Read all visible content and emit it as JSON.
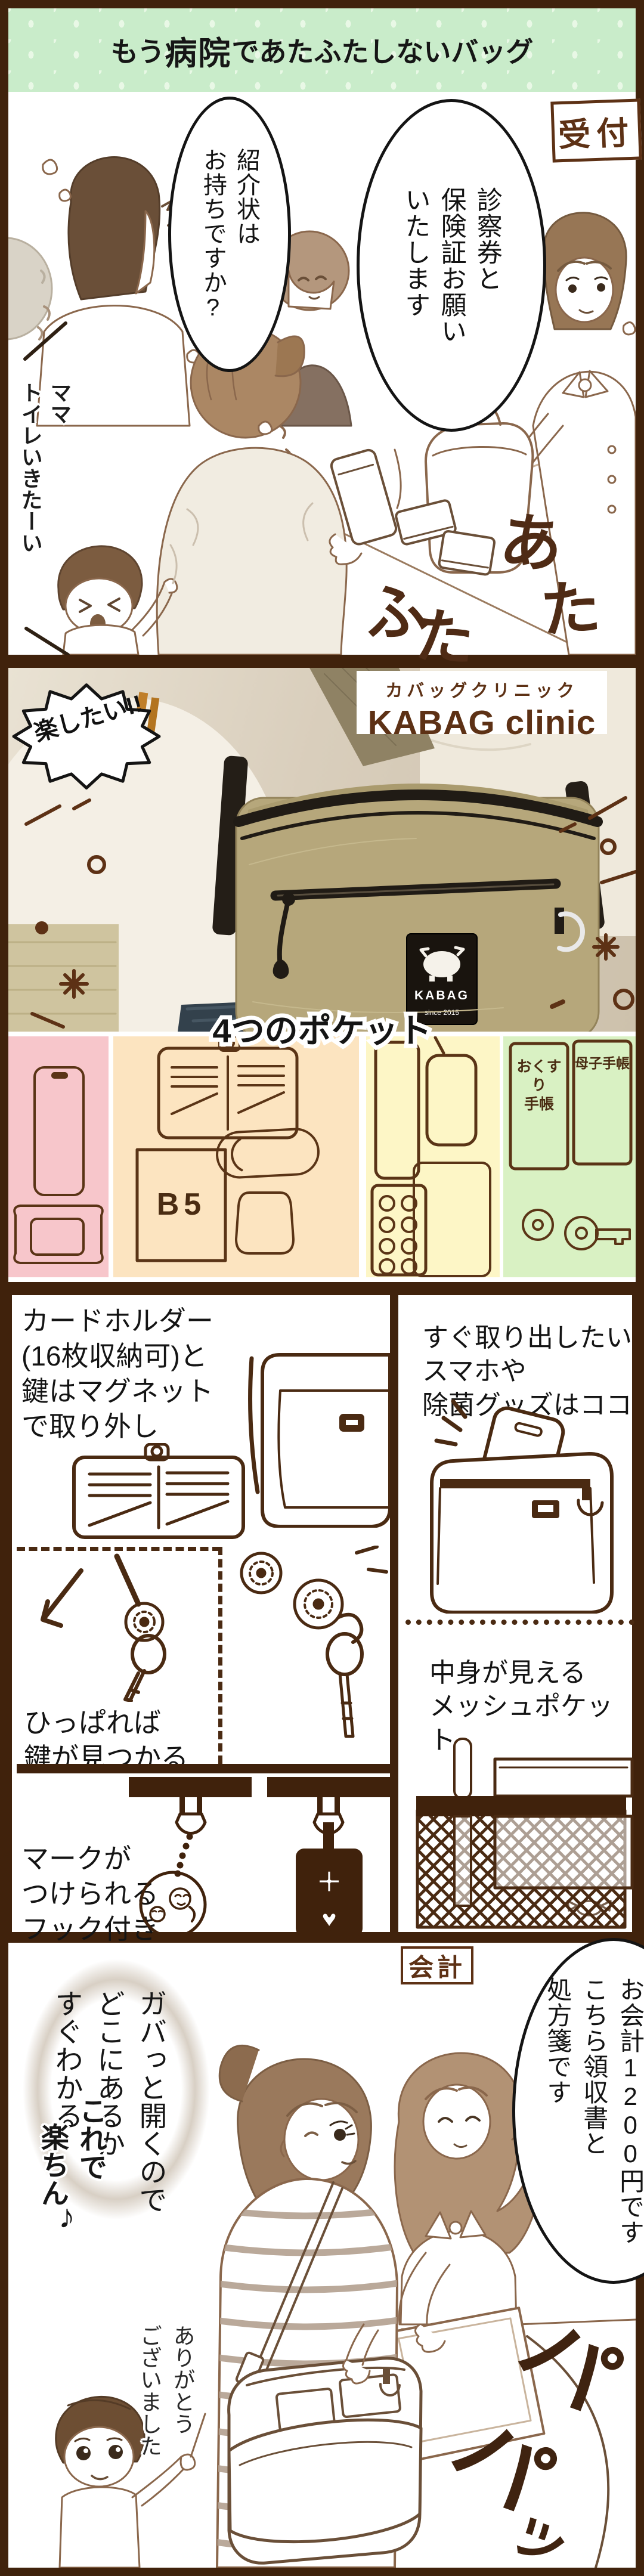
{
  "banner": {
    "seg_mou": "もう",
    "seg_hospital": "病院",
    "seg_de": "で",
    "seg_rest": " あたふたしないバッグ"
  },
  "panel1": {
    "reception_label": "受付",
    "bubble_insurance": "診察券と\n保険証お願い\nいたします",
    "bubble_referral": "紹介状は\nお持ちですか?",
    "child_text": "ママ\nトイレいきたーい",
    "sfx_chars": [
      "あ",
      "た",
      "ふ",
      "た"
    ]
  },
  "panel2": {
    "burst": "楽したい!!",
    "brand_jp": "カバッグクリニック",
    "brand_en": "KABAG clinic",
    "tag_brand": "KABAG",
    "tag_since": "since 2015"
  },
  "panel3": {
    "title": "4つのポケット",
    "b5_label": "B5",
    "notebook_medicine": "おくすり\n手帳",
    "notebook_mother": "母子手帳"
  },
  "panel4": {
    "card_title": "カードホルダー\n(16枚収納可)と\n鍵はマグネット\nで取り外し",
    "pull_text": "ひっぱれば\n鍵が見つかる",
    "hook_text": "マークが\nつけられる\nフック付き",
    "quick_title": "すぐ取り出したい\nスマホや\n除菌グッズはココ",
    "mesh_text": "中身が見える\nメッシュポケット",
    "tag_plus": "+",
    "tag_heart": "♥"
  },
  "panel5": {
    "checkout_label": "会計",
    "bubble_payment": "お会計1200円です\nこちら領収書と\n処方箋です",
    "bubble_open": "ガバっと開くので\nどこにあるか\nすぐわかる",
    "easy_line1": "これで",
    "easy_line2": "楽ちん",
    "easy_note": "♪",
    "thanks_text": "ありがとう\nございました",
    "sfx_chars": [
      "パ",
      "パ",
      "ッ"
    ]
  },
  "colors": {
    "frame_brown": "#40220c",
    "banner_green": "#c9ecca",
    "banner_dot": "#e9f8e6",
    "text_brown": "#5d3115",
    "sfx_brown": "#4f2b15",
    "pocket_pink": "#f7c6cb",
    "pocket_peach": "#fce4c0",
    "pocket_yellow": "#fdf6c6",
    "pocket_green": "#d9f1c3",
    "bag_khaki": "#b6a77b",
    "lineart_sepia": "#8a674c",
    "diagram_brown": "#4a2a12"
  }
}
